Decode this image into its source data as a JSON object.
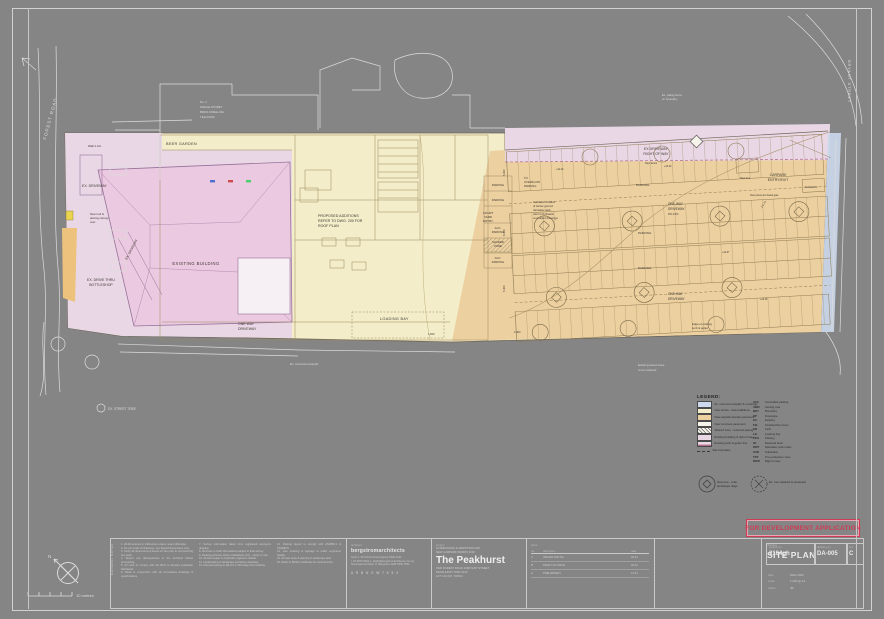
{
  "sheet": {
    "stamp": "FOR DEVELOPMENT APPLICATION",
    "north_label": "N",
    "scale_text": "10  metres"
  },
  "plan": {
    "streets": {
      "left": "FOREST ROAD",
      "right": "BRYANT STREET"
    },
    "labels": {
      "wall_note": "Wall 1.0m",
      "beer_garden": "BEER GARDEN",
      "ex_driveway": "EX. DRIVEWAY",
      "awning1": "New roof &",
      "awning2": "awning canopy",
      "awning3": "over",
      "bottleshop1": "EX. DRIVE THRU",
      "bottleshop2": "BOTTLESHOP",
      "existing_building": "EXISTING BUILDING",
      "ex_driveway_diag": "EX. DRIVEWAY",
      "proposed1": "PROPOSED ADDITIONS",
      "proposed2": "REFER TO DWG. 200 FOR",
      "proposed3": "ROOF PLAN",
      "one_way_sw1": "ONE WAY",
      "one_way_sw2": "DRIVEWAY",
      "loading_bay": "LOADING BAY",
      "courtyard1": "COURT",
      "courtyard2": "YARD",
      "courtyard3": "ENTRY",
      "parking_sm1": "PARKING",
      "parking_sm2": "PARKING",
      "acc1": "ACC.",
      "acc2": "PARKING",
      "shared1": "SHARED",
      "shared2": "ZONE",
      "acc3": "ACC.",
      "acc4": "PARKING",
      "overflow1": "TO",
      "overflow2": "OVERFLOW",
      "overflow3": "PARKING",
      "rain1": "Indicative location",
      "rain2": "of below ground",
      "rain3": "rainwater tank,",
      "rain4": "refer to hydraulic",
      "rain5": "consultant drawings",
      "row1": "EX DRIVEWAY",
      "row2": "RIGHT OF WAY",
      "carpark_entry1": "CARPARK",
      "carpark_entry2": "ENTRY/EXIT",
      "substation": "Substation",
      "new_tree": "New tree",
      "gate_note": "New picket and board gate",
      "ramp_note": "1 in 20",
      "one_way_a1": "ONE-WAY",
      "one_way_a2": "DRIVEWAY",
      "grad_note": "DN 4.5%",
      "one_way_b1": "ONE-WAY",
      "one_way_b2": "DRIVEWAY",
      "parking_r1": "PARKING",
      "parking_r2": "PARKING",
      "parking_r3": "PARKING",
      "kerb_note1": "Edge of existing",
      "kerb_note2": "kerb & gutter",
      "footpath_note": "Ex. concrete footpath",
      "street_trees1": "Existing street trees",
      "street_trees2": "to be retained",
      "neighbour1": "No. 4",
      "neighbour2": "SINGLE STOREY",
      "neighbour3": "BRICK DWELLING",
      "neighbour4": "TILE ROOF",
      "fence_note1": "Ex. paling fence",
      "fence_note2": "on boundary",
      "new_fence": "New fence",
      "street_tree_sym": "EX. STREET TREE"
    },
    "dims": [
      "5,400",
      "6,400",
      "5,400",
      "2,400",
      "1,500"
    ],
    "levels": [
      "+44.20",
      "+43.40",
      "+42.67",
      "+42.46"
    ]
  },
  "legend": {
    "title": "LEGEND:",
    "swatches": [
      {
        "color": "#ccd9ec",
        "label": "Ex. concrete footpath & crossings"
      },
      {
        "color": "#f3edc9",
        "label": "New works - hotel additions"
      },
      {
        "color": "#ecd0a0",
        "label": "New asphalt carpark pavement"
      },
      {
        "color": "#f6f3ea",
        "label": "New concrete pavement"
      },
      {
        "color": "hatch",
        "label": "Shared zone - textured paving"
      },
      {
        "color": "#e9d7e5",
        "label": "Existing building & right of way"
      },
      {
        "color": "stripe",
        "label": "Existing kerb & gutter line"
      },
      {
        "color": "dash",
        "label": "Site boundary"
      }
    ],
    "abbr": [
      [
        "ACC",
        "Accessible parking"
      ],
      [
        "AWN",
        "Awning over"
      ],
      [
        "BDY",
        "Boundary"
      ],
      [
        "DP",
        "Downpipe"
      ],
      [
        "EX.",
        "Existing"
      ],
      [
        "FFL",
        "Finished floor level"
      ],
      [
        "KB",
        "Kerb"
      ],
      [
        "LB",
        "Loading bay"
      ],
      [
        "PKG",
        "Parking"
      ],
      [
        "RL",
        "Reduced level"
      ],
      [
        "RWT",
        "Rainwater tank under"
      ],
      [
        "SUB",
        "Substation"
      ],
      [
        "TPZ",
        "Tree protection zone"
      ],
      [
        "ROW",
        "Right of way"
      ]
    ],
    "tree_new": "New tree - refer landscape dwgs",
    "tree_existing": "Ex. tree retained & protected"
  },
  "titleblock": {
    "notes_title": "GENERAL NOTES",
    "notes_col1": [
      "1. All dimensions in millimetres unless noted otherwise.",
      "2. Do not scale off drawings, use figured dimensions only.",
      "3. Verify all dimensions & levels on site prior to commencing any work.",
      "4. Report any discrepancies to the architect before proceeding.",
      "5. All work to comply with the BCA & relevant Australian Standards.",
      "6. Read in conjunction with all consultants drawings & specifications."
    ],
    "notes_col2": [
      "7. Survey information taken from registered surveyors drawing.",
      "8. All levels to AHD. Boundaries subject to final survey.",
      "9. Existing services shown indicatively only - verify on site.",
      "10. All stormwater to hydraulic engineers details.",
      "11. Landscaping to landscape architects drawings.",
      "12. External paving to fall min 1:100 away from building."
    ],
    "notes_col3": [
      "13. Parking layout to comply with AS2890.1 & AS2890.6.",
      "14. Line marking & signage to traffic engineers details.",
      "15. All new trees & planting to landscape plan.",
      "16. Refer to BASIX certificate for commitments."
    ],
    "architect_label": "architect",
    "architect_name": "bergstromarchitects",
    "architect_addr1": "Suite 2, 46 Oxford Street Epping NSW 2121",
    "architect_addr2": "t. 02 9876 5432   e. studio@bergstromarchitects.com.au",
    "architect_addr3": "Nominated architect: P. Bergstrom  ARB NSW 7654",
    "architect_logo": "A R B   N S W   7 6 5 4",
    "project_label": "project",
    "project_line1": "ALTERATIONS & ADDITIONS AND",
    "project_line2": "NEW CARPARK WORKS FOR",
    "project_name": "The Peakhurst",
    "project_addr1": "CNR FOREST ROAD & BRYANT STREET,",
    "project_addr2": "PEAKHURST NSW 2210",
    "project_addr3": "LOT 101 D.P. 734521",
    "issue_label": "issue",
    "issue_head": [
      "rev",
      "description",
      "date"
    ],
    "issue_rows": [
      [
        "C",
        "ISSUED FOR DA",
        "03.22"
      ],
      [
        "B",
        "DRAFT DA ISSUE",
        "02.22"
      ],
      [
        "A",
        "PRELIMINARY",
        "12.21"
      ]
    ],
    "drawing_label": "drawing",
    "drawing_title": "SITE PLAN",
    "project_no_label": "project no.",
    "project_no": "2104gh",
    "drawing_no_label": "drawing no.",
    "drawing_no": "DA-005",
    "rev_label": "rev",
    "rev": "C",
    "date_label": "date",
    "date_value": "MAR 2022",
    "scale_label": "scale",
    "scale_value": "1:200 @ A1",
    "drawn_label": "drawn",
    "drawn_value": "JB"
  }
}
